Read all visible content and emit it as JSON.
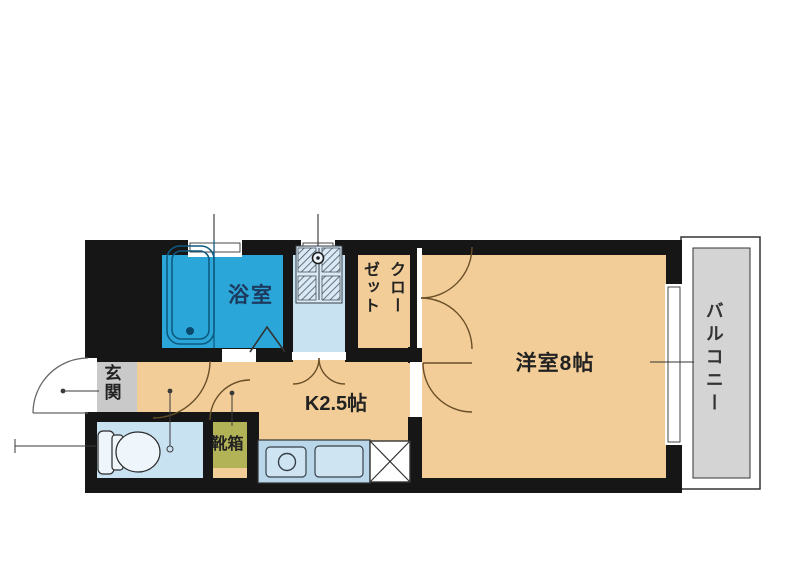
{
  "rooms": {
    "bathroom": "浴室",
    "closet": "クローゼット",
    "kitchen": "K2.5帖",
    "western_room": "洋室8帖",
    "balcony": "バルコニー",
    "entrance": "玄関",
    "shoe_box": "靴箱"
  },
  "colors": {
    "wall": "#161616",
    "floor": "#f2cd97",
    "bathroom": "#2aa7d8",
    "sanitary": "#c9e2f2",
    "pan": "#d9e9f5",
    "counter": "#bad7ea",
    "counter_item": "#cfe4f2",
    "entrance": "#c9c9c9",
    "balcony": "#d4d4d4",
    "shoe_box": "#b2b356",
    "tub_line": "#0e5a80",
    "door_arc": "#6a4f28",
    "leader": "#3a3a3a"
  }
}
